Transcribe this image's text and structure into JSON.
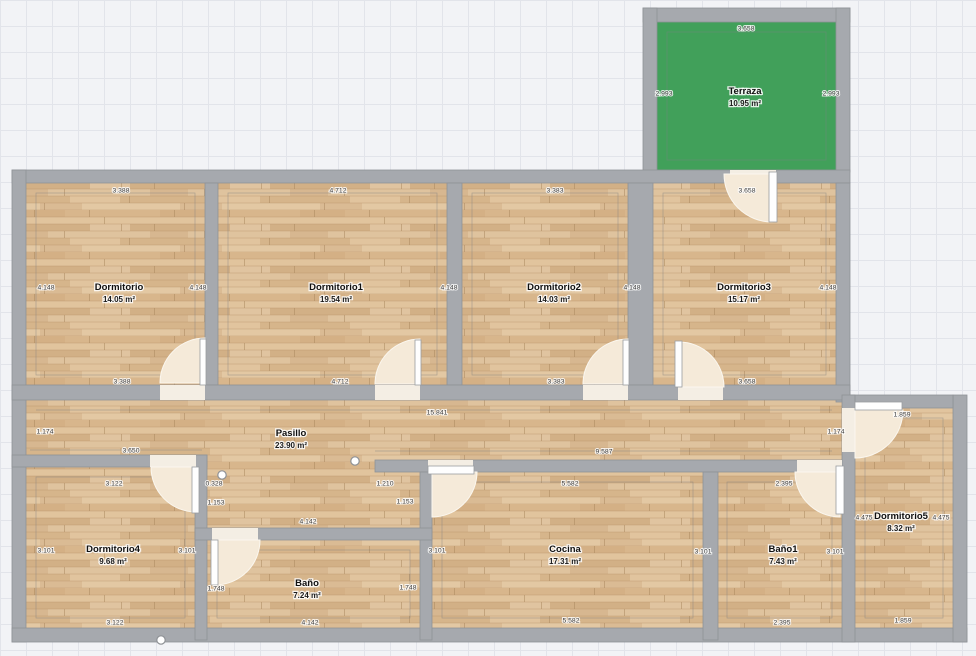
{
  "plan": {
    "colors": {
      "wall": "#a6a9ae",
      "terrace_green": "#41a05a",
      "floor_base": "#dcbe97",
      "door_swing": "#f5ead9",
      "threshold": "#f4eee4"
    },
    "rooms": [
      {
        "id": "terraza",
        "name": "Terraza",
        "area": "10.95 m²",
        "x": 745,
        "y": 91
      },
      {
        "id": "dormitorio",
        "name": "Dormitorio",
        "area": "14.05 m²",
        "x": 119,
        "y": 287
      },
      {
        "id": "dormitorio1",
        "name": "Dormitorio1",
        "area": "19.54 m²",
        "x": 336,
        "y": 287
      },
      {
        "id": "dormitorio2",
        "name": "Dormitorio2",
        "area": "14.03 m²",
        "x": 554,
        "y": 287
      },
      {
        "id": "dormitorio3",
        "name": "Dormitorio3",
        "area": "15.17 m²",
        "x": 744,
        "y": 287
      },
      {
        "id": "pasillo",
        "name": "Pasillo",
        "area": "23.90 m²",
        "x": 291,
        "y": 433
      },
      {
        "id": "dormitorio4",
        "name": "Dormitorio4",
        "area": "9.68 m²",
        "x": 113,
        "y": 549
      },
      {
        "id": "bano",
        "name": "Baño",
        "area": "7.24 m²",
        "x": 307,
        "y": 583
      },
      {
        "id": "cocina",
        "name": "Cocina",
        "area": "17.31 m²",
        "x": 565,
        "y": 549
      },
      {
        "id": "bano1",
        "name": "Baño1",
        "area": "7.43 m²",
        "x": 783,
        "y": 549
      },
      {
        "id": "dormitorio5",
        "name": "Dormitorio5",
        "area": "8.32 m²",
        "x": 901,
        "y": 516
      }
    ],
    "dim_labels": [
      {
        "t": "3.658",
        "x": 746,
        "y": 28
      },
      {
        "t": "2.993",
        "x": 664,
        "y": 93
      },
      {
        "t": "2.993",
        "x": 831,
        "y": 93
      },
      {
        "t": "3.388",
        "x": 121,
        "y": 190
      },
      {
        "t": "4.712",
        "x": 338,
        "y": 190
      },
      {
        "t": "3.383",
        "x": 555,
        "y": 190
      },
      {
        "t": "3.658",
        "x": 747,
        "y": 190
      },
      {
        "t": "4.148",
        "x": 46,
        "y": 287
      },
      {
        "t": "4.148",
        "x": 198,
        "y": 287
      },
      {
        "t": "4.148",
        "x": 449,
        "y": 287
      },
      {
        "t": "4.148",
        "x": 632,
        "y": 287
      },
      {
        "t": "4.148",
        "x": 828,
        "y": 287
      },
      {
        "t": "3.388",
        "x": 122,
        "y": 381
      },
      {
        "t": "4.712",
        "x": 340,
        "y": 381
      },
      {
        "t": "3.383",
        "x": 556,
        "y": 381
      },
      {
        "t": "3.658",
        "x": 747,
        "y": 381
      },
      {
        "t": "15.841",
        "x": 437,
        "y": 412
      },
      {
        "t": "1.174",
        "x": 45,
        "y": 431
      },
      {
        "t": "1.174",
        "x": 836,
        "y": 431
      },
      {
        "t": "3.650",
        "x": 131,
        "y": 450
      },
      {
        "t": "9.587",
        "x": 604,
        "y": 451
      },
      {
        "t": "0.328",
        "x": 214,
        "y": 483
      },
      {
        "t": "1.153",
        "x": 216,
        "y": 502
      },
      {
        "t": "1.210",
        "x": 385,
        "y": 483
      },
      {
        "t": "1.153",
        "x": 405,
        "y": 501
      },
      {
        "t": "3.122",
        "x": 114,
        "y": 483
      },
      {
        "t": "3.122",
        "x": 115,
        "y": 622
      },
      {
        "t": "3.101",
        "x": 46,
        "y": 550
      },
      {
        "t": "3.101",
        "x": 187,
        "y": 550
      },
      {
        "t": "4.142",
        "x": 308,
        "y": 521
      },
      {
        "t": "4.142",
        "x": 310,
        "y": 622
      },
      {
        "t": "1.748",
        "x": 216,
        "y": 588
      },
      {
        "t": "1.748",
        "x": 408,
        "y": 587
      },
      {
        "t": "5.582",
        "x": 570,
        "y": 483
      },
      {
        "t": "5.582",
        "x": 571,
        "y": 620
      },
      {
        "t": "3.101",
        "x": 437,
        "y": 550
      },
      {
        "t": "3.101",
        "x": 703,
        "y": 551
      },
      {
        "t": "2.395",
        "x": 784,
        "y": 483
      },
      {
        "t": "2.395",
        "x": 782,
        "y": 622
      },
      {
        "t": "3.101",
        "x": 835,
        "y": 551
      },
      {
        "t": "1.859",
        "x": 902,
        "y": 414
      },
      {
        "t": "1.859",
        "x": 903,
        "y": 620
      },
      {
        "t": "4.475",
        "x": 864,
        "y": 517
      },
      {
        "t": "4.475",
        "x": 941,
        "y": 517
      }
    ]
  }
}
